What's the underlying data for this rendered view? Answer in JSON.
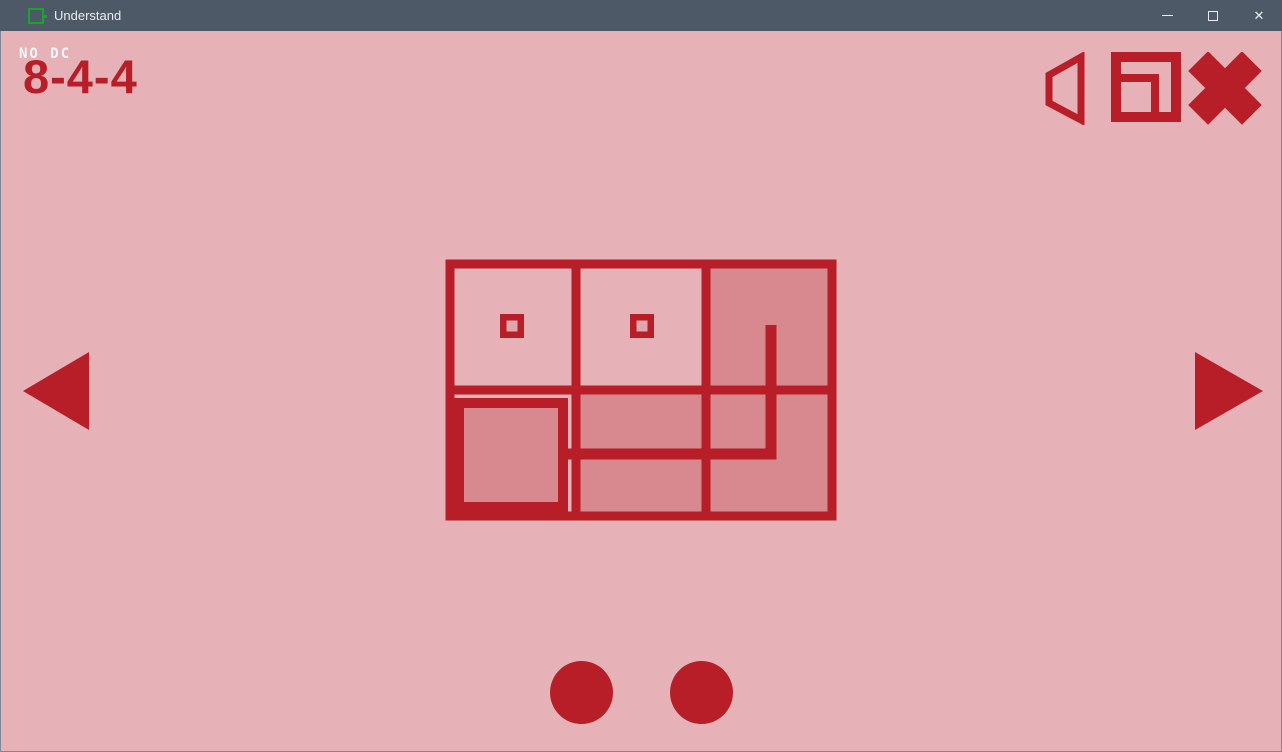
{
  "window": {
    "title": "Understand",
    "controls": {
      "minimize": "minimize",
      "maximize": "maximize",
      "close": "close",
      "close_glyph": "✕"
    }
  },
  "hud": {
    "hint": "NO DC",
    "level": "8-4-4"
  },
  "colors": {
    "accent": "#b71e27",
    "background": "#e6b2b8",
    "cell_shaded": "#d8888f",
    "marker_hole": "#dfa6ad",
    "titlebar": "#4d5966",
    "titlebar_text": "#e9edf2",
    "app_icon_green": "#18a52c",
    "window_border": "#7d8893"
  },
  "board": {
    "cols": 3,
    "rows": 2,
    "cell_size": 130,
    "shaded_cells": [
      [
        0,
        2
      ],
      [
        1,
        1
      ],
      [
        1,
        2
      ]
    ],
    "ring_cell": [
      1,
      0
    ],
    "square_markers": [
      [
        0,
        0
      ],
      [
        0,
        1
      ]
    ],
    "path_points": [
      [
        120,
        194
      ],
      [
        325,
        194
      ],
      [
        325,
        65
      ]
    ]
  },
  "footer": {
    "dot_count": 2
  }
}
